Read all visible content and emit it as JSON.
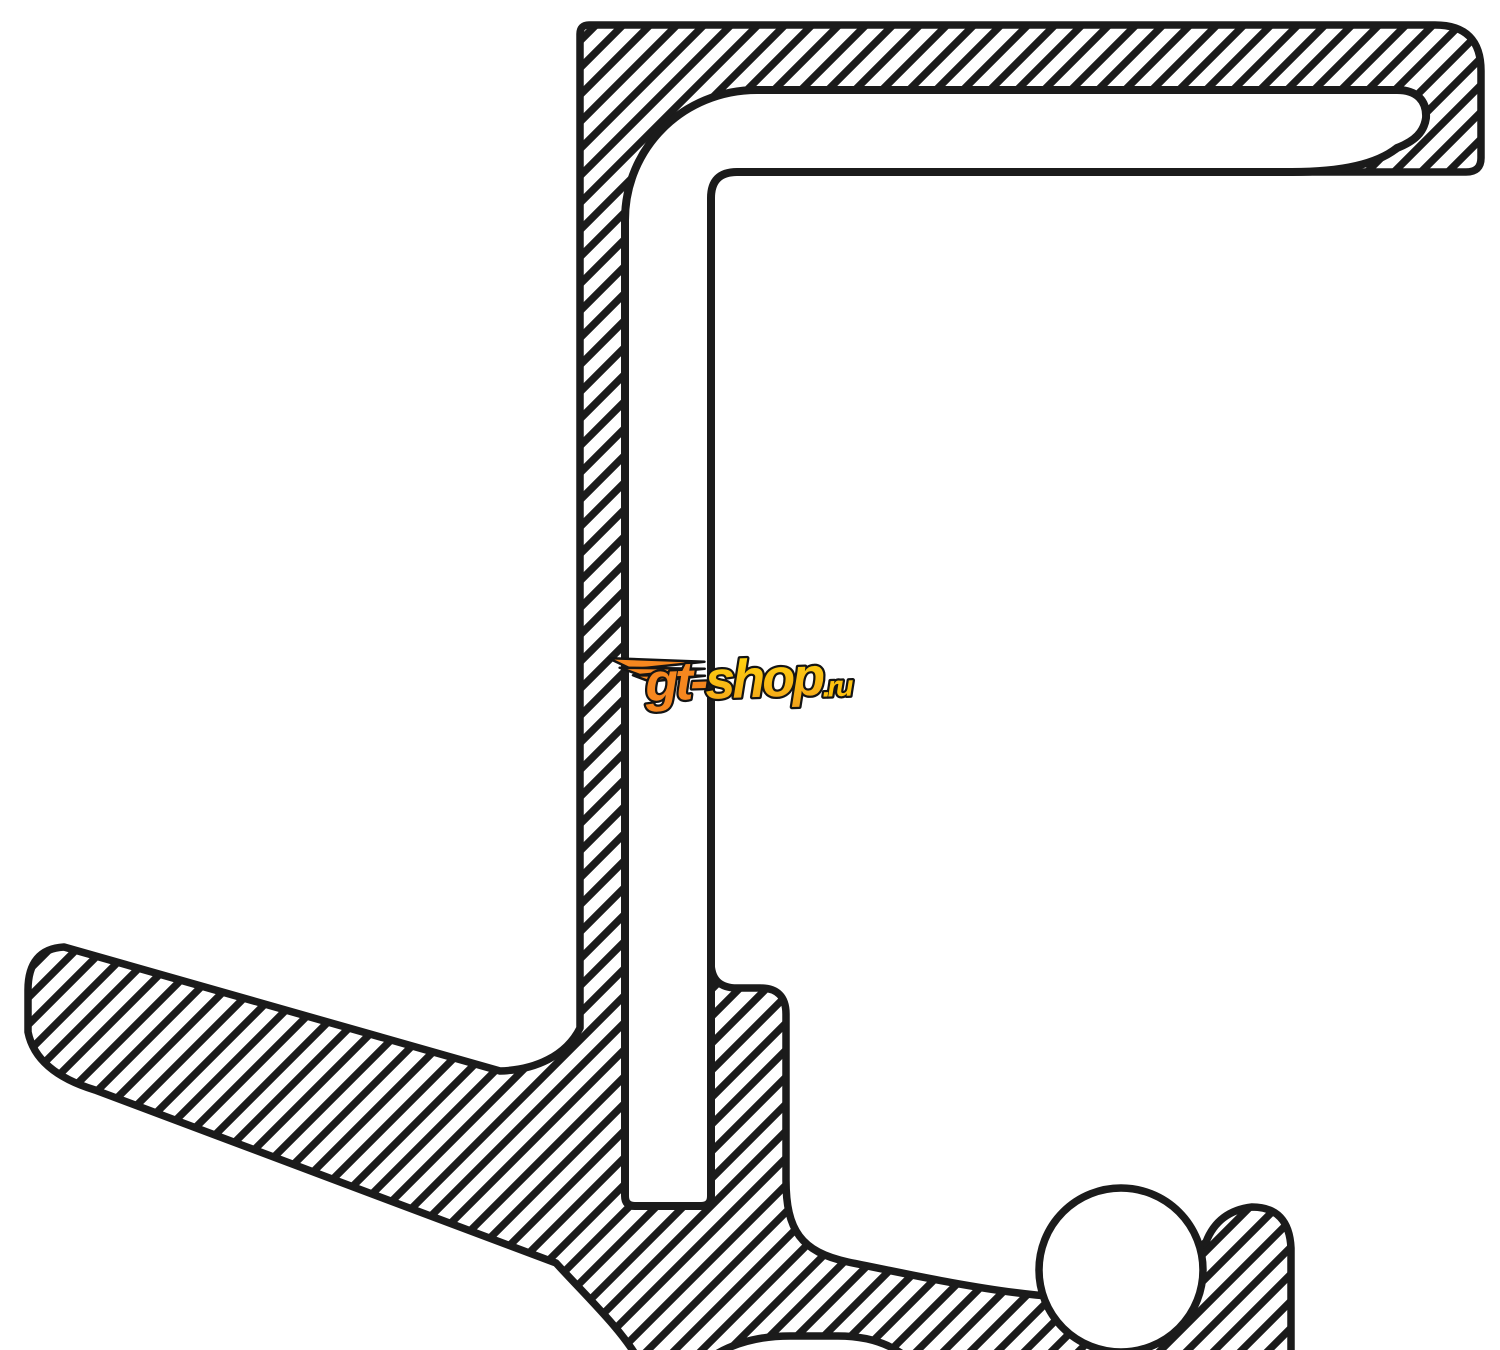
{
  "diagram": {
    "kind": "oil-seal-cross-section-drawing",
    "ink": "#1b1b1b",
    "background": "#ffffff"
  },
  "watermark": {
    "prefix": "gt-",
    "body": "shop",
    "suffix": ".ru",
    "colors": {
      "orange": "#f6871f",
      "gold_top": "#ffd20e",
      "gold_bottom": "#f2a11c",
      "yellow": "#ffc20e",
      "outline": "#141414"
    }
  }
}
